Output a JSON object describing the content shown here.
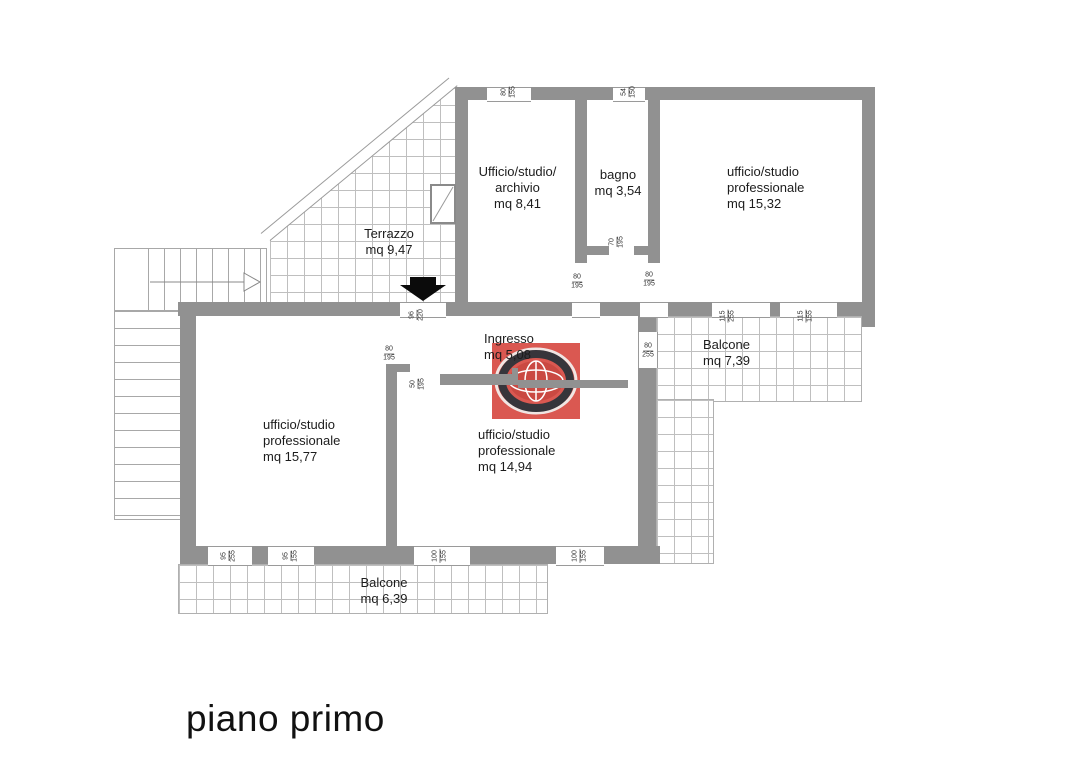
{
  "title": "piano primo",
  "rooms": {
    "archivio": {
      "line1": "Ufficio/studio/",
      "line2": "archivio",
      "line3": "mq 8,41"
    },
    "bagno": {
      "line1": "bagno",
      "line2": "mq 3,54"
    },
    "studio_15_32": {
      "line1": "ufficio/studio",
      "line2": "professionale",
      "line3": "mq 15,32"
    },
    "terrazzo": {
      "line1": "Terrazzo",
      "line2": "mq 9,47"
    },
    "ingresso": {
      "line1": "Ingresso",
      "line2": "mq 5,08"
    },
    "balcone_7_39": {
      "line1": "Balcone",
      "line2": "mq 7,39"
    },
    "studio_15_77": {
      "line1": "ufficio/studio",
      "line2": "professionale",
      "line3": "mq 15,77"
    },
    "studio_14_94": {
      "line1": "ufficio/studio",
      "line2": "professionale",
      "line3": "mq 14,94"
    },
    "balcone_6_39": {
      "line1": "Balcone",
      "line2": "mq 6,39"
    }
  },
  "dimensions": [
    {
      "w": "80",
      "h": "155"
    },
    {
      "w": "54",
      "h": "150"
    },
    {
      "w": "70",
      "h": "195"
    },
    {
      "w": "80",
      "h": "195"
    },
    {
      "w": "80",
      "h": "195"
    },
    {
      "w": "96",
      "h": "220"
    },
    {
      "w": "80",
      "h": "195"
    },
    {
      "w": "50",
      "h": "195"
    },
    {
      "w": "80",
      "h": "255"
    },
    {
      "w": "115",
      "h": "255"
    },
    {
      "w": "115",
      "h": "155"
    },
    {
      "w": "95",
      "h": "255"
    },
    {
      "w": "95",
      "h": "155"
    },
    {
      "w": "100",
      "h": "155"
    },
    {
      "w": "100",
      "h": "155"
    }
  ],
  "colors": {
    "wall": "#919191",
    "tile_line": "#bfbfbf",
    "watermark_red": "#d95048"
  }
}
